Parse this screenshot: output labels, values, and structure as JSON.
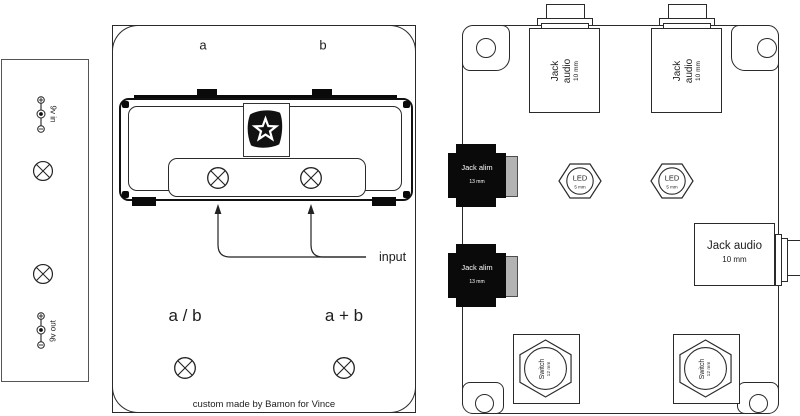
{
  "left_panel": {
    "in_label": "9v in",
    "out_label": "9v out"
  },
  "middle_panel": {
    "label_a": "a",
    "label_b": "b",
    "input_label": "input",
    "mode_ab": "a / b",
    "mode_a_plus_b": "a + b",
    "caption": "custom made by Bamon for Vince"
  },
  "right_panel": {
    "jack_top_left": {
      "name": "Jack audio",
      "size": "10 mm"
    },
    "jack_top_right": {
      "name": "Jack audio",
      "size": "10 mm"
    },
    "jack_out": {
      "name": "Jack audio",
      "size": "10 mm"
    },
    "alim_top": {
      "name": "Jack alim",
      "size": "13 mm"
    },
    "alim_bottom": {
      "name": "Jack alim",
      "size": "13 mm"
    },
    "led_left": {
      "name": "LED",
      "size": "5 mm"
    },
    "led_right": {
      "name": "LED",
      "size": "5 mm"
    },
    "switch_left": {
      "name": "Switch",
      "size": "12 mm"
    },
    "switch_right": {
      "name": "Switch",
      "size": "12 mm"
    }
  },
  "colors": {
    "line": "#222222",
    "black_fill": "#0a0a0a",
    "gray_fill": "#b3b3b3",
    "background": "#ffffff"
  }
}
